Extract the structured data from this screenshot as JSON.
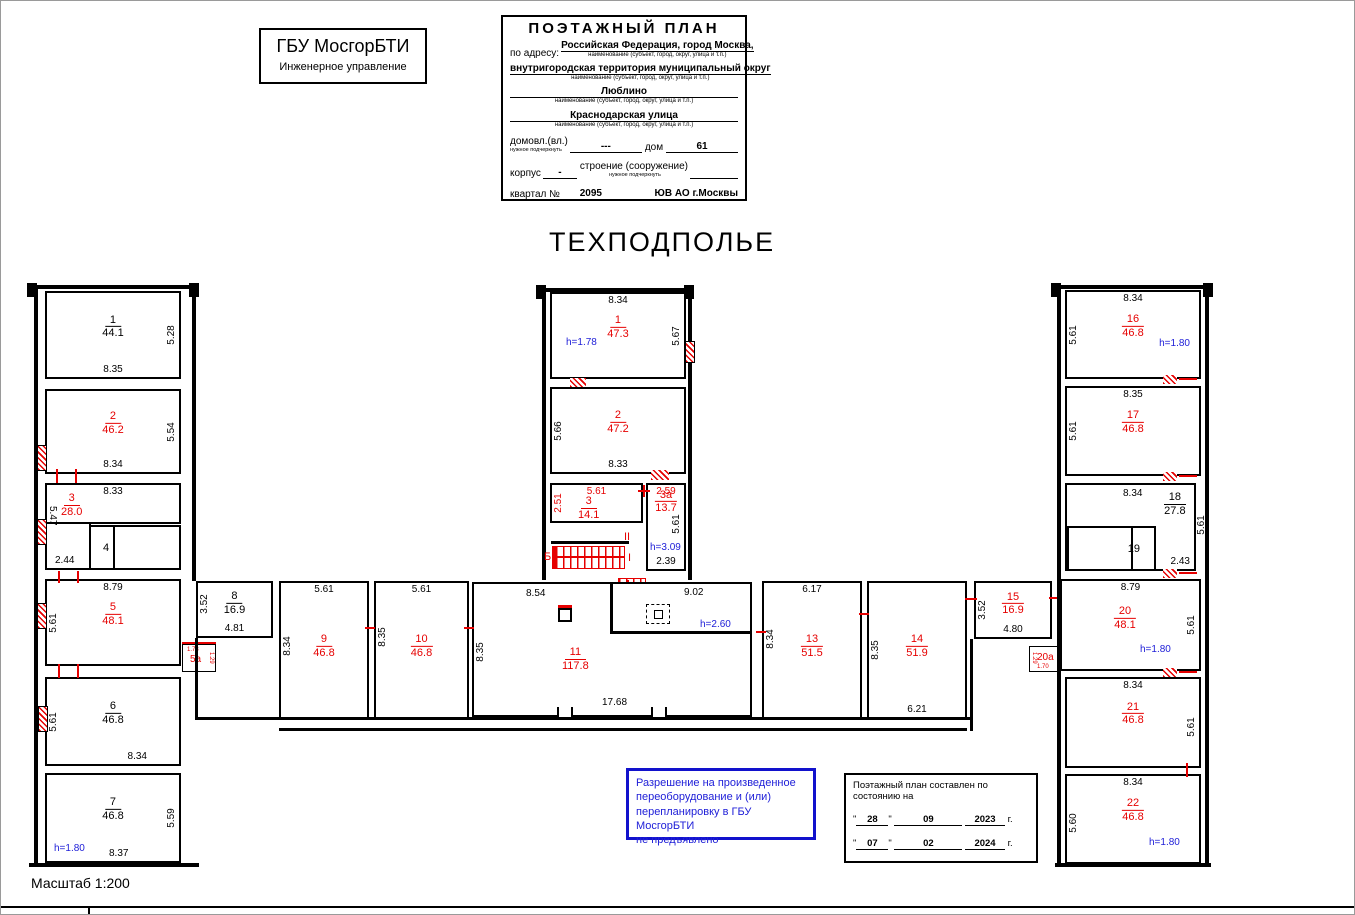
{
  "org_box": {
    "title": "ГБУ МосгорБТИ",
    "subtitle": "Инженерное управление"
  },
  "form": {
    "title": "ПОЭТАЖНЫЙ ПЛАН",
    "address_label": "по адресу:",
    "address_line1": "Российская Федерация, город Москва,",
    "address_line2": "внутригородская территория муниципальный округ",
    "address_line3": "Люблино",
    "address_line4": "Краснодарская улица",
    "name_caption": "наименование (субъект, город, округ, улица и т.п.)",
    "underline_caption": "нужное подчеркнуть",
    "domovl_label": "домовл.(вл.)",
    "domovl_value": "---",
    "dom_label": "дом",
    "dom_value": "61",
    "korpus_label": "корпус",
    "korpus_value": "-",
    "stroenie_label": "строение (сооружение)",
    "kvartal_label": "квартал №",
    "kvartal_value": "2095",
    "okrug_value": "ЮВ АО г.Москвы"
  },
  "plan_title": "ТЕХПОДПОЛЬЕ",
  "plan": {
    "rooms": {
      "L1": {
        "number": "1",
        "area": "44.1",
        "dim_right": "5.28",
        "dim_bottom": "8.35"
      },
      "L2": {
        "number": "2",
        "area": "46.2",
        "dim_right": "5.54",
        "dim_bottom": "8.34"
      },
      "L3": {
        "number": "3",
        "area": "28.0",
        "dim_top": "8.33",
        "dim_left": "5.47",
        "dim_bottom": "2.44"
      },
      "L4": {
        "number": "4"
      },
      "L5": {
        "number": "5",
        "area": "48.1",
        "dim_top": "8.79",
        "dim_left": "5.61"
      },
      "L5a": {
        "number": "5а",
        "dim_top": "1.73",
        "dim_right": "1.29"
      },
      "L6": {
        "number": "6",
        "area": "46.8",
        "dim_left": "5.61",
        "dim_bottom": "8.34"
      },
      "L7": {
        "number": "7",
        "area": "46.8",
        "dim_right": "5.59",
        "dim_bottom": "8.37",
        "height": "h=1.80"
      },
      "B8": {
        "number": "8",
        "area": "16.9",
        "dim_left": "3.52",
        "dim_bottom": "4.81"
      },
      "C1": {
        "number": "1",
        "area": "47.3",
        "dim_top": "8.34",
        "dim_right": "5.67",
        "height": "h=1.78"
      },
      "C2": {
        "number": "2",
        "area": "47.2",
        "dim_left": "5.66",
        "dim_bottom": "8.33"
      },
      "C3": {
        "number": "3",
        "area": "14.1",
        "dim_top": "5.61",
        "dim_left": "2.51"
      },
      "C3a": {
        "number": "3а",
        "area": "13.7",
        "dim_top": "2.59",
        "dim_right": "5.61",
        "height": "h=3.09",
        "dim_bottom": "2.39"
      },
      "B9": {
        "number": "9",
        "area": "46.8",
        "dim_top": "5.61",
        "dim_left": "8.34"
      },
      "B10": {
        "number": "10",
        "area": "46.8",
        "dim_top": "5.61",
        "dim_left": "8.35"
      },
      "B11": {
        "number": "11",
        "area": "117.8",
        "dim_top_left": "8.54",
        "dim_top_right": "9.02",
        "dim_left": "8.35",
        "dim_bottom": "17.68",
        "height": "h=2.60"
      },
      "B13": {
        "number": "13",
        "area": "51.5",
        "dim_top": "6.17",
        "dim_left": "8.34"
      },
      "B14": {
        "number": "14",
        "area": "51.9",
        "dim_left": "8.35",
        "dim_bottom": "6.21"
      },
      "B15": {
        "number": "15",
        "area": "16.9",
        "dim_left": "3.52",
        "dim_bottom": "4.80"
      },
      "B20a": {
        "number": "20а",
        "dim_bottom": "1.70",
        "dim_left": "1.29"
      },
      "R16": {
        "number": "16",
        "area": "46.8",
        "dim_top": "8.34",
        "dim_left": "5.61",
        "height": "h=1.80"
      },
      "R17": {
        "number": "17",
        "area": "46.8",
        "dim_top": "8.35",
        "dim_left": "5.61"
      },
      "R18": {
        "number": "18",
        "area": "27.8",
        "dim_top": "8.34",
        "dim_right": "5.61",
        "dim_bottom": "2.43"
      },
      "R19": {
        "number": "19"
      },
      "R20": {
        "number": "20",
        "area": "48.1",
        "dim_top": "8.79",
        "dim_right": "5.61",
        "height": "h=1.80"
      },
      "R21": {
        "number": "21",
        "area": "46.8",
        "dim_top": "8.34",
        "dim_right": "5.61"
      },
      "R22": {
        "number": "22",
        "area": "46.8",
        "dim_top": "8.34",
        "dim_left": "5.60",
        "height": "h=1.80"
      }
    },
    "stair": {
      "label": "Б",
      "flight_upper": "II",
      "flight_lower": "I"
    }
  },
  "permission_note": {
    "line1": "Разрешение на произведенное",
    "line2": "переоборудование и (или)",
    "line3": "перепланировку в ГБУ МосгорБТИ",
    "line4": "не предъявлено"
  },
  "stamp": {
    "title": "Поэтажный план составлен по состоянию на",
    "rows": [
      {
        "q": "\"",
        "day": "28",
        "month": "09",
        "year": "2023",
        "suffix": "г."
      },
      {
        "q": "\"",
        "day": "07",
        "month": "02",
        "year": "2024",
        "suffix": "г."
      }
    ]
  },
  "scale_label": "Масштаб 1:200"
}
